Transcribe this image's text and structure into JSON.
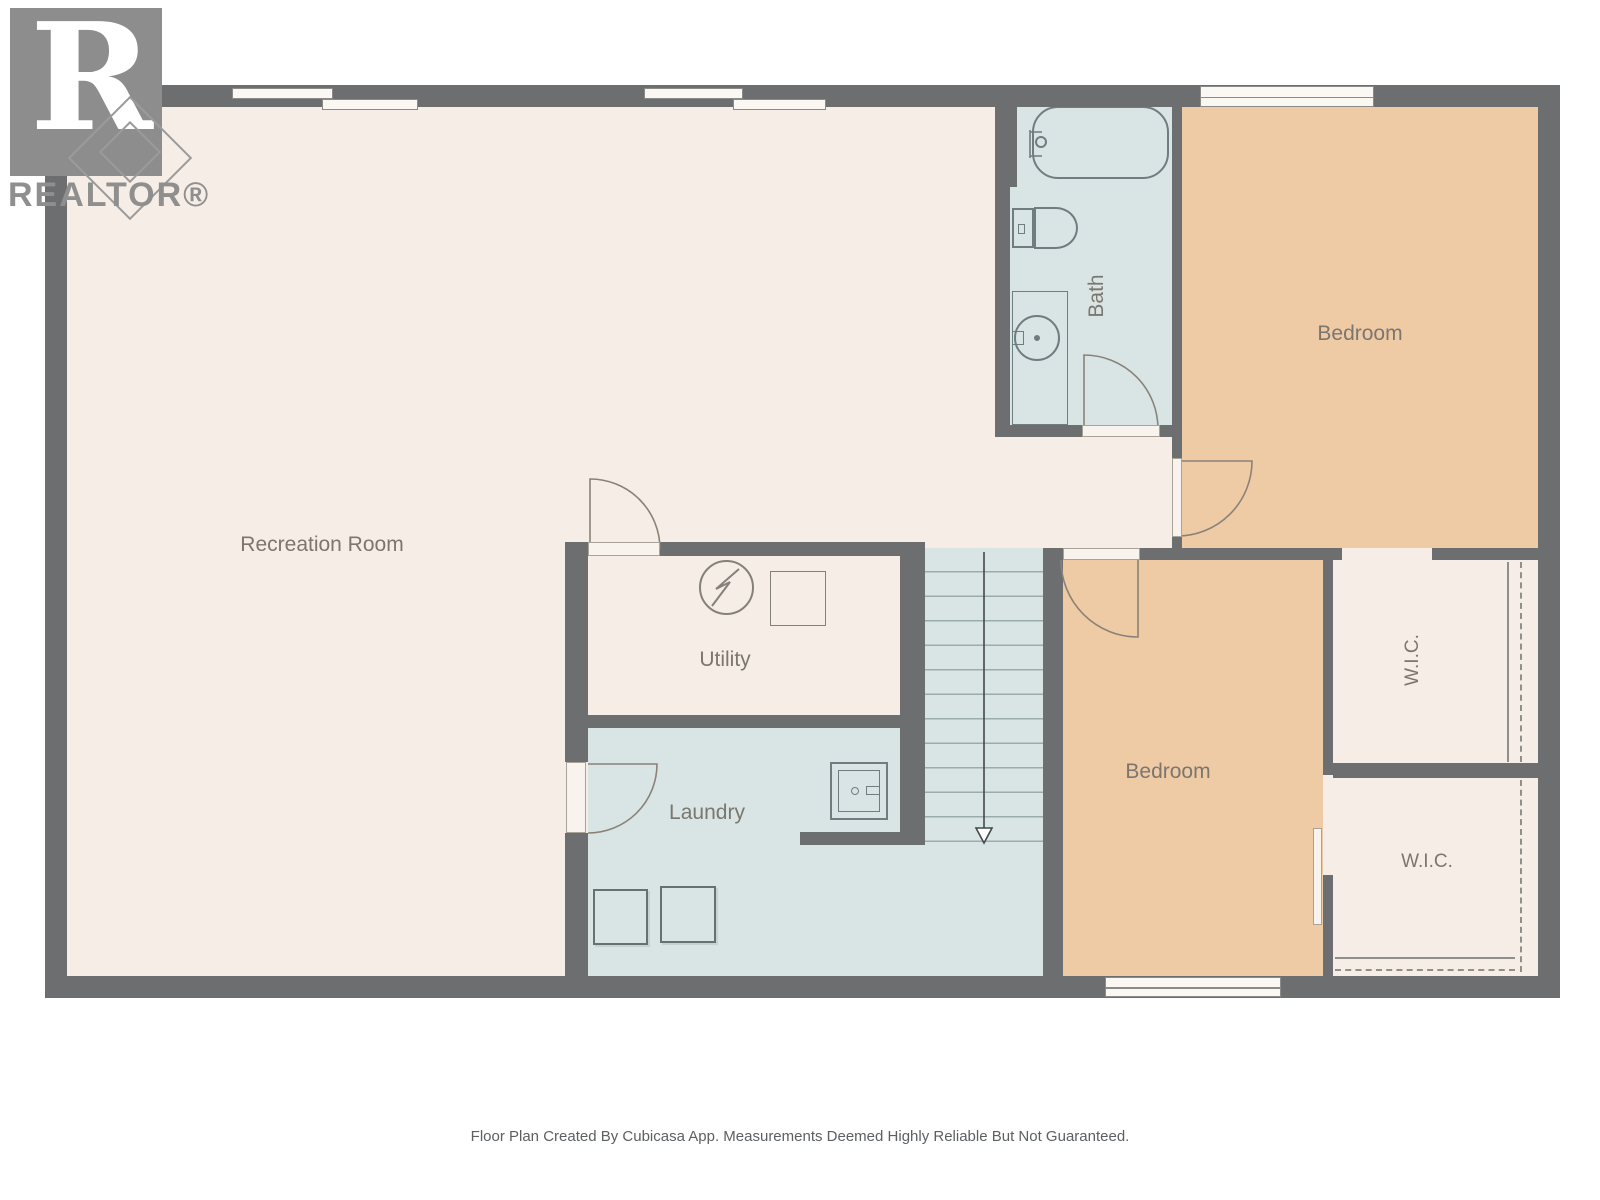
{
  "logo": {
    "text": "REALTOR®"
  },
  "rooms": {
    "recreation": {
      "label": "Recreation Room"
    },
    "bath": {
      "label": "Bath"
    },
    "bedroom_top": {
      "label": "Bedroom"
    },
    "bedroom_bottom": {
      "label": "Bedroom"
    },
    "utility": {
      "label": "Utility"
    },
    "laundry": {
      "label": "Laundry"
    },
    "wic_top": {
      "label": "W.I.C."
    },
    "wic_bottom": {
      "label": "W.I.C."
    }
  },
  "footer": {
    "disclaimer": "Floor Plan Created By Cubicasa App. Measurements Deemed Highly Reliable But Not Guaranteed."
  },
  "colors": {
    "wall": "#6d6e70",
    "floor_cream": "#f6ede7",
    "floor_blue": "#d9e5e5",
    "floor_tan": "#eecaa5",
    "fixture_line": "#6e7d80",
    "icon_line": "#84807a",
    "label_text": "#7c766f",
    "door_leaf": "#f8f4ed",
    "door_line": "#8a8278",
    "window_fill": "#fbf8f3",
    "window_line": "#8a8a88",
    "stair_tread": "#9bacad",
    "arrow": "#44484a",
    "closet_line": "#8f8f8c",
    "logo_gray": "#8f8f8f",
    "footer_text": "#5c6063",
    "page_bg": "#ffffff"
  }
}
